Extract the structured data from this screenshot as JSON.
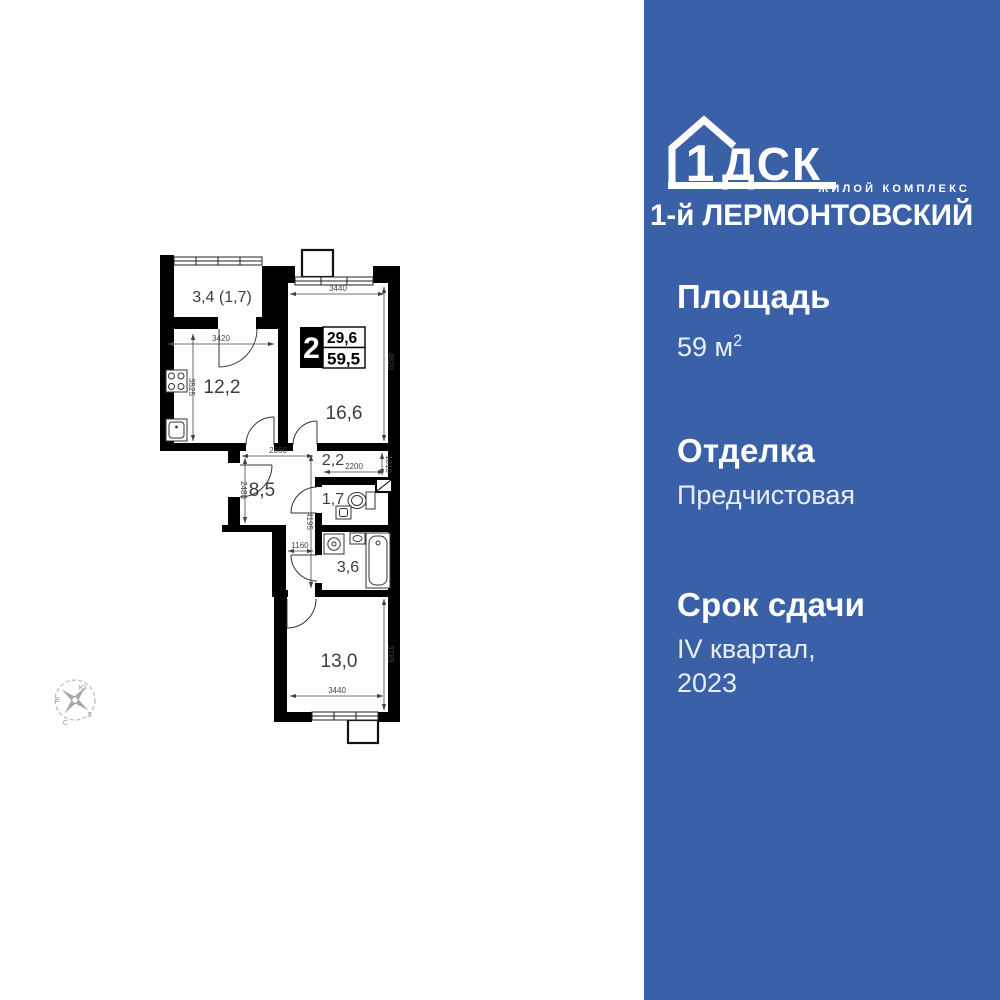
{
  "colors": {
    "panel-bg": "#3a61a8",
    "text": "#ffffff",
    "text-soft": "#e9eef7",
    "wall": "#000000"
  },
  "brand": {
    "logo_digit": "1",
    "logo_letters": "ДСК",
    "subtitle": "ЖИЛОЙ КОМПЛЕКС",
    "name": "1-й ЛЕРМОНТОВСКИЙ"
  },
  "specs": {
    "area_label": "Площадь",
    "area_value": "59 м",
    "area_sup": "2",
    "finish_label": "Отделка",
    "finish_value": "Предчистовая",
    "deadline_label": "Срок сдачи",
    "deadline_line1": "IV квартал,",
    "deadline_line2": "2023"
  },
  "plan": {
    "badge": {
      "rooms": "2",
      "upper": "29,6",
      "lower": "59,5"
    },
    "rooms": {
      "balcony": "3,4 (1,7)",
      "kitchen": "12,2",
      "living": "16,6",
      "corridor": "2,2",
      "hall": "8,5",
      "wc": "1,7",
      "bath": "3,6",
      "bedroom": "13,0"
    },
    "dims": {
      "kitchen_w": "3420",
      "kitchen_h": "3525",
      "living_w": "3440",
      "living_h": "4820",
      "hall_w": "2660",
      "hall_h": "2480",
      "wc_w": "2200",
      "corridor_h": "1010",
      "column_h": "4195",
      "passage_w": "1160",
      "bedroom_w": "3440",
      "bedroom_h": "3785"
    },
    "compass": {
      "south": "Ю",
      "east": "В",
      "west": "З",
      "north": "С"
    }
  }
}
